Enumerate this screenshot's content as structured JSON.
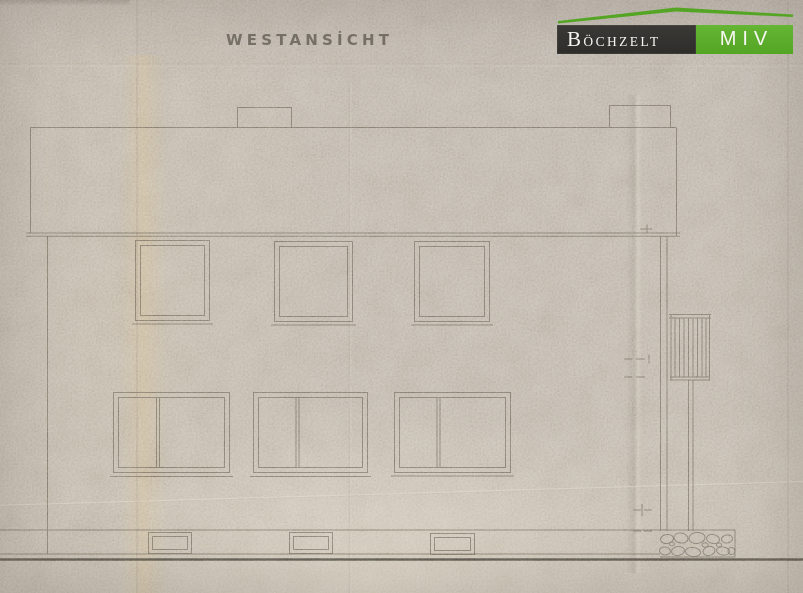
{
  "document": {
    "title": "WESTANSİCHT"
  },
  "logo": {
    "brand_initial": "B",
    "brand_rest": "ÖCHZELT",
    "division": "MIV"
  },
  "drawing": {
    "kind": "architectural west elevation, pencil on aged paper",
    "upper_window_count": 3,
    "lower_window_count": 3,
    "basement_window_count": 3,
    "chimney_count": 2
  },
  "colors": {
    "paper": "#b7aea1",
    "pencil": "#6a6459",
    "pencil-dark": "#4a453d",
    "title-ink": "#6f6a60",
    "logo-dark": "#3b3936",
    "logo-green": "#55a525",
    "logo-text": "#f6f6f2"
  }
}
